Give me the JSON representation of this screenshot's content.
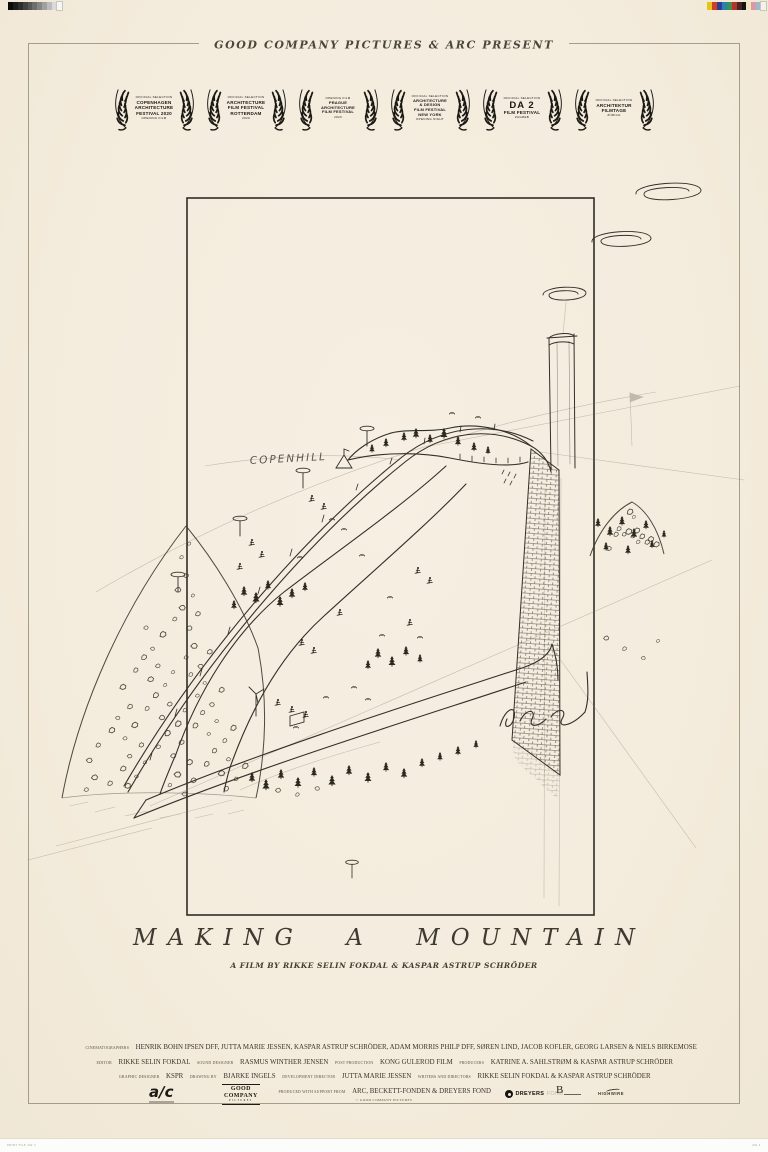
{
  "poster": {
    "presenter": "GOOD COMPANY PICTURES & ARC PRESENT",
    "title": "MAKING A MOUNTAIN",
    "byline": "A FILM BY RIKKE SELIN FOKDAL & KASPAR ASTRUP SCHRÖDER"
  },
  "laurels": [
    {
      "id": "copenhagen-architecture-festival",
      "lines": [
        {
          "size": "xs",
          "text": "OFFICIAL SELECTION"
        },
        {
          "size": "md",
          "text": "COPENHAGEN"
        },
        {
          "size": "md",
          "text": "ARCHITECTURE"
        },
        {
          "size": "md",
          "text": "FESTIVAL 2020"
        },
        {
          "size": "xs",
          "text": "OPENING FILM"
        }
      ]
    },
    {
      "id": "architecture-film-festival-rotterdam",
      "lines": [
        {
          "size": "xs",
          "text": "OFFICIAL SELECTION"
        },
        {
          "size": "md",
          "text": "ARCHITECTURE"
        },
        {
          "size": "md",
          "text": "FILM FESTIVAL"
        },
        {
          "size": "md",
          "text": "ROTTERDAM"
        },
        {
          "size": "xs",
          "text": "2020"
        }
      ]
    },
    {
      "id": "prague-architecture-film-festival",
      "lines": [
        {
          "size": "xs",
          "text": "OPENING FILM"
        },
        {
          "size": "sm",
          "text": "PRAGUE"
        },
        {
          "size": "sm",
          "text": "ARCHITECTURE"
        },
        {
          "size": "sm",
          "text": "FILM FESTIVAL"
        },
        {
          "size": "xs",
          "text": "2020"
        }
      ]
    },
    {
      "id": "architecture-design-film-festival-new-york",
      "lines": [
        {
          "size": "xs",
          "text": "OFFICIAL SELECTION"
        },
        {
          "size": "sm",
          "text": "ARCHITECTURE"
        },
        {
          "size": "sm",
          "text": "& DESIGN"
        },
        {
          "size": "sm",
          "text": "FILM FESTIVAL"
        },
        {
          "size": "sm",
          "text": "NEW YORK"
        },
        {
          "size": "xs",
          "text": "OPENING NIGHT"
        }
      ]
    },
    {
      "id": "da2-film-festival",
      "lines": [
        {
          "size": "xs",
          "text": "OFFICIAL SELECTION"
        },
        {
          "size": "lg",
          "text": "DA 2"
        },
        {
          "size": "md",
          "text": "FILM FESTIVAL"
        },
        {
          "size": "xs",
          "text": "ZAGREB"
        }
      ]
    },
    {
      "id": "architektur-filmtage-zurich",
      "lines": [
        {
          "size": "xs",
          "text": "OFFICIAL SELECTION"
        },
        {
          "size": "md",
          "text": "ARCHITEKTUR"
        },
        {
          "size": "md",
          "text": "FILMTAGE"
        },
        {
          "size": "xs",
          "text": "ZÜRICH"
        }
      ]
    }
  ],
  "sketch": {
    "label": "COPENHILL"
  },
  "credits": {
    "lines": [
      [
        {
          "r": 1,
          "t": "CINEMATOGRAPHERS"
        },
        {
          "t": "HENRIK BOHN IPSEN DFF, JUTTA MARIE JESSEN, KASPAR ASTRUP SCHRÖDER, ADAM MORRIS PHILP DFF, SØREN LIND, JACOB KOFLER, GEORG LARSEN & NIELS BIRKEMOSE"
        }
      ],
      [
        {
          "r": 1,
          "t": "EDITOR"
        },
        {
          "t": "RIKKE SELIN FOKDAL"
        },
        {
          "r": 1,
          "t": "SOUND DESIGNER"
        },
        {
          "t": "RASMUS WINTHER JENSEN"
        },
        {
          "r": 1,
          "t": "POST PRODUCTION"
        },
        {
          "t": "KONG GULEROD FILM"
        },
        {
          "r": 1,
          "t": "PRODUCERS"
        },
        {
          "t": "KATRINE A. SAHLSTRØM & KASPAR ASTRUP SCHRÖDER"
        }
      ],
      [
        {
          "r": 1,
          "t": "GRAPHIC DESIGNER"
        },
        {
          "t": "KSPR"
        },
        {
          "r": 1,
          "t": "DRAWING BY"
        },
        {
          "t": "BJARKE INGELS"
        },
        {
          "r": 1,
          "t": "DEVELOPMENT DIRECTOR"
        },
        {
          "t": "JUTTA MARIE JESSEN"
        },
        {
          "r": 1,
          "t": "WRITERS AND DIRECTORS"
        },
        {
          "t": "RIKKE SELIN FOKDAL & KASPAR ASTRUP SCHRÖDER"
        }
      ]
    ],
    "support": [
      {
        "r": 1,
        "t": "PRODUCED WITH SUPPORT FROM"
      },
      {
        "t": "ARC, BECKETT-FONDEN & DREYERS FOND"
      }
    ],
    "copyright": "© GOOD COMPANY PICTURES"
  },
  "logos": {
    "arc": "a∕c",
    "good_company": [
      "GOOD",
      "COMPANY",
      "PICTURES"
    ],
    "dreyers_bold": "DREYERS",
    "dreyers_light": "FOND",
    "beckett": "B",
    "highwire": "HIGHWIRE"
  },
  "print_marks": {
    "grayscale": [
      "#0a0a0a",
      "#1c1c1c",
      "#2e2e2e",
      "#424242",
      "#575757",
      "#6e6e6e",
      "#868686",
      "#a0a0a0",
      "#bcbcbc",
      "#dadada",
      "#f6f6f6"
    ],
    "colorbar": [
      "#e6c419",
      "#cf3f28",
      "#2d3f8e",
      "#2e7fb5",
      "#3f8f4f",
      "#b5332e",
      "#4a2420",
      "#141414",
      "#efe6bb",
      "#d99aa6",
      "#9fb8cc",
      "#f5f2ea"
    ],
    "file_note_left": "PRINT FILE AW 1",
    "file_note_right": "AW 1"
  },
  "colors": {
    "background": "#f4edde",
    "ink": "#32302a",
    "frame": "#a59c89",
    "laurel": "#1b1914"
  }
}
